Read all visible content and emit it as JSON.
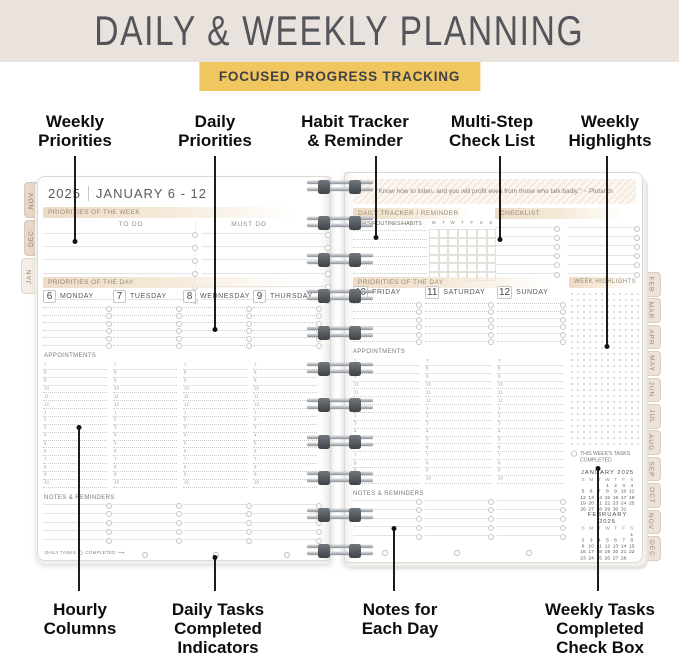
{
  "colors": {
    "banner_bg": "#e9e2dd",
    "title": "#54555a",
    "badge_bg": "#f0c75e",
    "badge_text": "#414247",
    "tab_bg": "#ece2d6",
    "tab_text": "#99897a"
  },
  "banner": {
    "title": "DAILY & WEEKLY PLANNING",
    "badge": "FOCUSED PROGRESS TRACKING"
  },
  "callouts": {
    "top": [
      {
        "label": "Weekly\nPriorities"
      },
      {
        "label": "Daily\nPriorities"
      },
      {
        "label": "Habit Tracker\n& Reminder"
      },
      {
        "label": "Multi-Step\nCheck List"
      },
      {
        "label": "Weekly\nHighlights"
      }
    ],
    "bottom": [
      {
        "label": "Hourly\nColumns"
      },
      {
        "label": "Daily Tasks\nCompleted\nIndicators"
      },
      {
        "label": "Notes for\nEach Day"
      },
      {
        "label": "Weekly Tasks\nCompleted\nCheck Box"
      }
    ]
  },
  "tabs": {
    "left": [
      "NOV",
      "DEC",
      "JAN"
    ],
    "right": [
      "FEB",
      "MAR",
      "APR",
      "MAY",
      "JUN",
      "JUL",
      "AUG",
      "SEP",
      "OCT",
      "NOV",
      "DEC"
    ]
  },
  "hours": [
    "7",
    "8",
    "9",
    "10",
    "11",
    "12",
    "1",
    "2",
    "3",
    "4",
    "5",
    "6",
    "7",
    "8",
    "9",
    "10"
  ],
  "left_page": {
    "year": "2025",
    "week": "JANUARY 6 - 12",
    "priorities_week_label": "PRIORITIES OF THE WEEK",
    "todo_label": "TO DO",
    "mustdo_label": "MUST DO",
    "priorities_day_label": "PRIORITIES OF THE DAY",
    "days": [
      {
        "num": "6",
        "name": "MONDAY"
      },
      {
        "num": "7",
        "name": "TUESDAY"
      },
      {
        "num": "8",
        "name": "WEDNESDAY"
      },
      {
        "num": "9",
        "name": "THURSDAY"
      }
    ],
    "appointments_label": "APPOINTMENTS",
    "notes_label": "NOTES & REMINDERS",
    "daily_tasks_note": "DAILY TASKS",
    "completed_note": "COMPLETED",
    "arrow": "⟶"
  },
  "right_page": {
    "quote": "\"Know how to listen, and you will profit even from those who talk badly.\" ~ Plutarch",
    "tracker_label": "DAILY TRACKER / REMINDER",
    "tracker_sub": "TASKS/ROUTINES/HABITS",
    "tracker_days": [
      "M",
      "T",
      "W",
      "T",
      "F",
      "S",
      "S"
    ],
    "checklist_label": "CHECKLIST",
    "priorities_day_label": "PRIORITIES OF THE DAY",
    "week_highlights_label": "WEEK HIGHLIGHTS",
    "days": [
      {
        "num": "10",
        "name": "FRIDAY"
      },
      {
        "num": "11",
        "name": "SATURDAY"
      },
      {
        "num": "12",
        "name": "SUNDAY"
      }
    ],
    "appointments_label": "APPOINTMENTS",
    "notes_label": "NOTES & REMINDERS",
    "weekly_tasks_note": "THIS WEEK'S TASKS COMPLETED",
    "mini_calendars": [
      {
        "title": "JANUARY",
        "year": "2025",
        "headers": [
          "S",
          "M",
          "T",
          "W",
          "T",
          "F",
          "S"
        ],
        "weeks": [
          [
            "",
            "",
            "",
            "1",
            "2",
            "3",
            "4"
          ],
          [
            "5",
            "6",
            "7",
            "8",
            "9",
            "10",
            "11"
          ],
          [
            "12",
            "13",
            "14",
            "15",
            "16",
            "17",
            "18"
          ],
          [
            "19",
            "20",
            "21",
            "22",
            "23",
            "24",
            "25"
          ],
          [
            "26",
            "27",
            "28",
            "29",
            "30",
            "31",
            ""
          ]
        ]
      },
      {
        "title": "FEBRUARY",
        "year": "2025",
        "headers": [
          "S",
          "M",
          "T",
          "W",
          "T",
          "F",
          "S"
        ],
        "weeks": [
          [
            "",
            "",
            "",
            "",
            "",
            "",
            "1"
          ],
          [
            "2",
            "3",
            "4",
            "5",
            "6",
            "7",
            "8"
          ],
          [
            "9",
            "10",
            "11",
            "12",
            "13",
            "14",
            "15"
          ],
          [
            "16",
            "17",
            "18",
            "19",
            "20",
            "21",
            "22"
          ],
          [
            "23",
            "24",
            "25",
            "26",
            "27",
            "28",
            ""
          ]
        ]
      }
    ]
  }
}
